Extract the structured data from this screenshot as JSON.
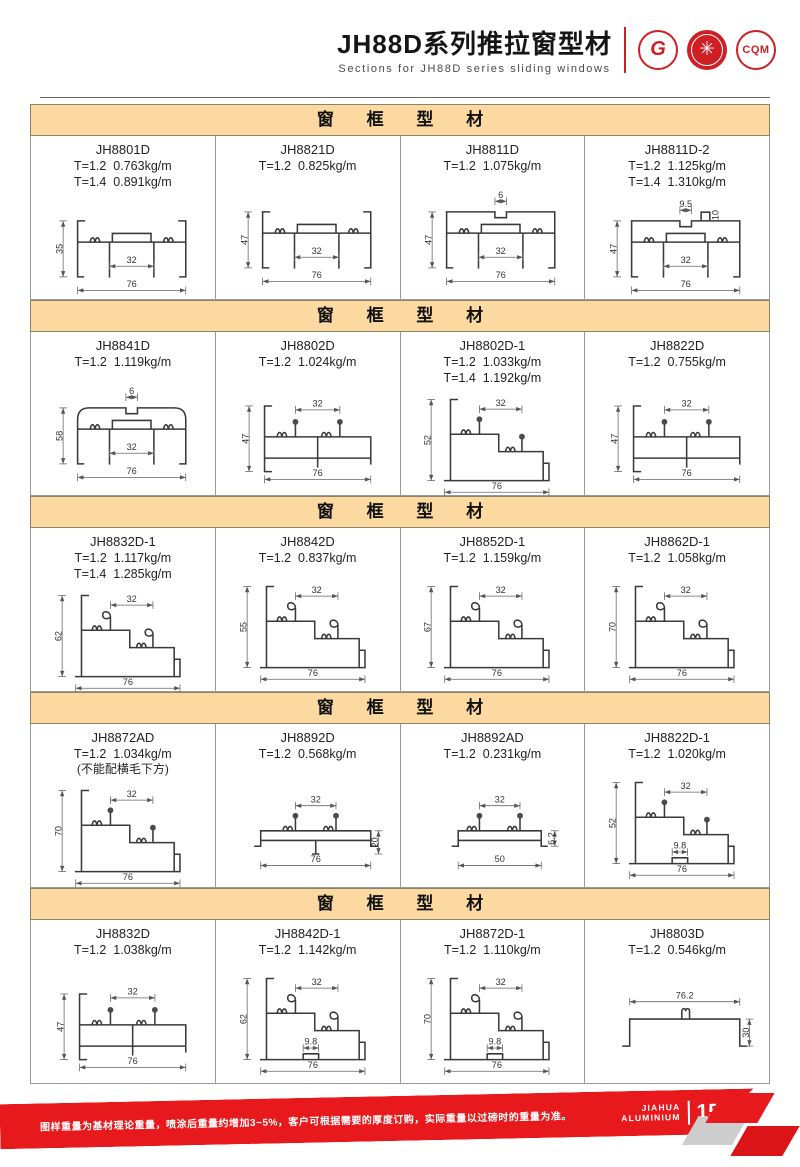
{
  "header": {
    "title": "JH88D系列推拉窗型材",
    "subtitle": "Sections for JH88D series sliding windows",
    "logo_gb": "G",
    "logo_emblem": "✳",
    "logo_cqm": "CQM"
  },
  "colors": {
    "accent_red": "#E8191C",
    "section_bar_bg": "#FBD9A0",
    "section_bar_border": "#8B8268",
    "drawing_line": "#3A3A3A"
  },
  "sections": [
    {
      "title": "窗 框 型 材",
      "cells": [
        {
          "code": "JH8801D",
          "spec1": "T=1.2  0.763kg/m",
          "spec2": "T=1.4  0.891kg/m",
          "drawing": {
            "kind": "frame",
            "covered": false,
            "left": "35",
            "inner": "32",
            "bottom": "76"
          }
        },
        {
          "code": "JH8821D",
          "spec1": "T=1.2  0.825kg/m",
          "drawing": {
            "kind": "frame",
            "covered": false,
            "left": "47",
            "inner": "32",
            "bottom": "76"
          }
        },
        {
          "code": "JH8811D",
          "spec1": "T=1.2  1.075kg/m",
          "drawing": {
            "kind": "frame",
            "covered": true,
            "top": "6",
            "left": "47",
            "inner": "32",
            "bottom": "76"
          }
        },
        {
          "code": "JH8811D-2",
          "spec1": "T=1.2  1.125kg/m",
          "spec2": "T=1.4  1.310kg/m",
          "drawing": {
            "kind": "frame",
            "covered": true,
            "top": "9.5",
            "top2": "10",
            "left": "47",
            "inner": "32",
            "bottom": "76"
          }
        }
      ]
    },
    {
      "title": "窗 框 型 材",
      "cells": [
        {
          "code": "JH8841D",
          "spec1": "T=1.2  1.119kg/m",
          "drawing": {
            "kind": "frame",
            "covered": true,
            "rounded": true,
            "top": "6",
            "left": "58",
            "inner": "32",
            "bottom": "76"
          }
        },
        {
          "code": "JH8802D",
          "spec1": "T=1.2  1.024kg/m",
          "drawing": {
            "kind": "track",
            "left": "47",
            "top": "32",
            "bottom": "76"
          }
        },
        {
          "code": "JH8802D-1",
          "spec1": "T=1.2  1.033kg/m",
          "spec2": "T=1.4  1.192kg/m",
          "drawing": {
            "kind": "step",
            "heads": "stud",
            "left": "52",
            "top": "32",
            "bottom": "76"
          }
        },
        {
          "code": "JH8822D",
          "spec1": "T=1.2  0.755kg/m",
          "drawing": {
            "kind": "track",
            "left": "47",
            "top": "32",
            "bottom": "76"
          }
        }
      ]
    },
    {
      "title": "窗 框 型 材",
      "cells": [
        {
          "code": "JH8832D-1",
          "spec1": "T=1.2  1.117kg/m",
          "spec2": "T=1.4  1.285kg/m",
          "drawing": {
            "kind": "step",
            "heads": "hook",
            "left": "62",
            "top": "32",
            "bottom": "76"
          }
        },
        {
          "code": "JH8842D",
          "spec1": "T=1.2  0.837kg/m",
          "drawing": {
            "kind": "step",
            "heads": "hook",
            "left": "55",
            "top": "32",
            "bottom": "76"
          }
        },
        {
          "code": "JH8852D-1",
          "spec1": "T=1.2  1.159kg/m",
          "drawing": {
            "kind": "step",
            "heads": "hook",
            "left": "67",
            "top": "32",
            "bottom": "76"
          }
        },
        {
          "code": "JH8862D-1",
          "spec1": "T=1.2  1.058kg/m",
          "drawing": {
            "kind": "step",
            "heads": "hook",
            "left": "70",
            "top": "32",
            "bottom": "76"
          }
        }
      ]
    },
    {
      "title": "窗 框 型 材",
      "cells": [
        {
          "code": "JH8872AD",
          "spec1": "T=1.2  1.034kg/m",
          "note": "(不能配横毛下方)",
          "drawing": {
            "kind": "step",
            "heads": "stud",
            "left": "70",
            "top": "32",
            "bottom": "76"
          }
        },
        {
          "code": "JH8892D",
          "spec1": "T=1.2  0.568kg/m",
          "drawing": {
            "kind": "bar",
            "studs": true,
            "top": "32",
            "right": "20",
            "bottom": "76"
          }
        },
        {
          "code": "JH8892AD",
          "spec1": "T=1.2  0.231kg/m",
          "drawing": {
            "kind": "bar",
            "studs": true,
            "top": "32",
            "right": "6.2",
            "bottom": "50"
          }
        },
        {
          "code": "JH8822D-1",
          "spec1": "T=1.2  1.020kg/m",
          "drawing": {
            "kind": "step",
            "heads": "stud",
            "left": "52",
            "top": "32",
            "mid": "9.8",
            "bottom": "76"
          }
        }
      ]
    },
    {
      "title": "窗 框 型 材",
      "cells": [
        {
          "code": "JH8832D",
          "spec1": "T=1.2  1.038kg/m",
          "drawing": {
            "kind": "track",
            "left": "47",
            "top": "32",
            "bottom": "76"
          }
        },
        {
          "code": "JH8842D-1",
          "spec1": "T=1.2  1.142kg/m",
          "drawing": {
            "kind": "step",
            "heads": "hook",
            "left": "62",
            "top": "32",
            "mid": "9.8",
            "bottom": "76"
          }
        },
        {
          "code": "JH8872D-1",
          "spec1": "T=1.2  1.110kg/m",
          "drawing": {
            "kind": "step",
            "heads": "hook",
            "left": "70",
            "top": "32",
            "mid": "9.8",
            "bottom": "76"
          }
        },
        {
          "code": "JH8803D",
          "spec1": "T=1.2  0.546kg/m",
          "drawing": {
            "kind": "bar",
            "studs": false,
            "top": "76.2",
            "right": "30"
          }
        }
      ]
    }
  ],
  "footer": {
    "note": "图样重量为基材理论重量，喷涂后重量约增加3~5%，客户可根据需要的厚度订购，实际重量以过磅时的重量为准。",
    "brand_line1": "JIAHUA",
    "brand_line2": "ALUMINIUM",
    "page_number": "15"
  }
}
